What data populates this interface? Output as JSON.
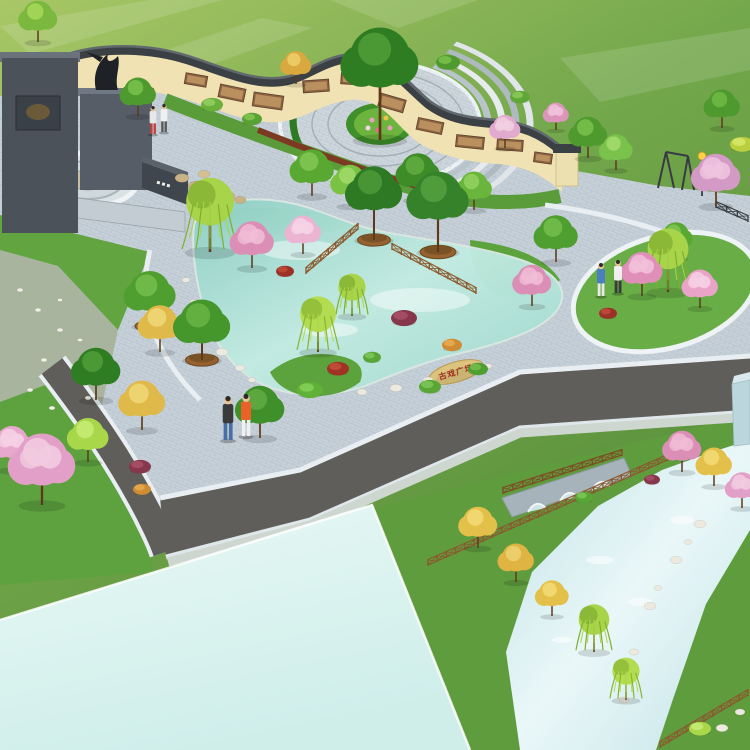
{
  "alt_text": "Aerial 3D landscape rendering of a public plaza park: S-curved cream mural wall with dark tile coping, dark stone entry monument with sculpture, circular ring-paved court with central tree, ornamental kidney-shaped pond with rock cascade, flowering and willow trees, curved roads, a canal with a stone arch bridge and wooden fences, and a large pale reflecting water surface",
  "palette": {
    "field_light": "#a9c766",
    "field_mid": "#74a84c",
    "field_dark": "#558c38",
    "paving": "#c6d0d8",
    "paving_edge": "#e8eef2",
    "road": "#5f5e5a",
    "sidewalk": "#cdd7d0",
    "wall_cream": "#f0e2b2",
    "wall_coping": "#3b4044",
    "mural_brown": "#8a6242",
    "wall_base_red": "#7c3a22",
    "pond_light": "#d9f2ec",
    "pond_deep": "#8ecfc4",
    "big_water": "#ddf3f0",
    "canal_water": "#cfe9ec",
    "monument_dark": "#4c525a",
    "monument_mid": "#575d66",
    "wood_fence": "#8a5a2e",
    "stone_tan": "#dcc47e",
    "grass_bed": "#5da33d"
  },
  "scene": {
    "stone_inscription": {
      "text": "古戏广场",
      "color": "#a32c1e"
    },
    "murals": [
      {
        "x": 196,
        "y": 80,
        "w": 22,
        "h": 11,
        "r": 10
      },
      {
        "x": 232,
        "y": 93,
        "w": 26,
        "h": 13,
        "r": 12
      },
      {
        "x": 268,
        "y": 101,
        "w": 30,
        "h": 14,
        "r": 8
      },
      {
        "x": 316,
        "y": 86,
        "w": 26,
        "h": 12,
        "r": -4
      },
      {
        "x": 352,
        "y": 79,
        "w": 22,
        "h": 11,
        "r": 4
      },
      {
        "x": 392,
        "y": 103,
        "w": 26,
        "h": 13,
        "r": 16
      },
      {
        "x": 430,
        "y": 126,
        "w": 26,
        "h": 12,
        "r": 12
      },
      {
        "x": 470,
        "y": 142,
        "w": 28,
        "h": 12,
        "r": 6
      },
      {
        "x": 510,
        "y": 145,
        "w": 26,
        "h": 11,
        "r": 4
      },
      {
        "x": 543,
        "y": 158,
        "w": 18,
        "h": 10,
        "r": 8
      }
    ],
    "stones": [
      {
        "x": 208,
        "y": 332,
        "r": 5,
        "c": "#eceadf"
      },
      {
        "x": 222,
        "y": 352,
        "r": 6,
        "c": "#eceadf"
      },
      {
        "x": 240,
        "y": 368,
        "r": 5,
        "c": "#eceadf"
      },
      {
        "x": 194,
        "y": 302,
        "r": 4,
        "c": "#eceadf"
      },
      {
        "x": 186,
        "y": 280,
        "r": 4,
        "c": "#eceadf"
      },
      {
        "x": 252,
        "y": 380,
        "r": 4,
        "c": "#eceadf"
      },
      {
        "x": 362,
        "y": 392,
        "r": 5,
        "c": "#eceadf"
      },
      {
        "x": 396,
        "y": 388,
        "r": 6,
        "c": "#eceadf"
      },
      {
        "x": 428,
        "y": 380,
        "r": 5,
        "c": "#eceadf"
      },
      {
        "x": 488,
        "y": 366,
        "r": 4,
        "c": "#eceadf"
      },
      {
        "x": 700,
        "y": 524,
        "r": 6,
        "c": "#eceadf"
      },
      {
        "x": 676,
        "y": 560,
        "r": 6,
        "c": "#eceadf"
      },
      {
        "x": 650,
        "y": 606,
        "r": 6,
        "c": "#eceadf"
      },
      {
        "x": 634,
        "y": 652,
        "r": 5,
        "c": "#eceadf"
      },
      {
        "x": 624,
        "y": 700,
        "r": 5,
        "c": "#eceadf"
      },
      {
        "x": 688,
        "y": 542,
        "r": 4,
        "c": "#eceadf"
      },
      {
        "x": 658,
        "y": 588,
        "r": 4,
        "c": "#eceadf"
      },
      {
        "x": 722,
        "y": 728,
        "r": 6,
        "c": "#eceadf"
      },
      {
        "x": 740,
        "y": 712,
        "r": 5,
        "c": "#eceadf"
      },
      {
        "x": 20,
        "y": 290,
        "r": 3,
        "c": "#f0efe6"
      },
      {
        "x": 38,
        "y": 310,
        "r": 3,
        "c": "#f0efe6"
      },
      {
        "x": 60,
        "y": 330,
        "r": 3,
        "c": "#f0efe6"
      },
      {
        "x": 44,
        "y": 360,
        "r": 3,
        "c": "#f0efe6"
      },
      {
        "x": 74,
        "y": 366,
        "r": 3,
        "c": "#f0efe6"
      },
      {
        "x": 30,
        "y": 390,
        "r": 3,
        "c": "#f0efe6"
      },
      {
        "x": 88,
        "y": 398,
        "r": 3,
        "c": "#f0efe6"
      },
      {
        "x": 60,
        "y": 300,
        "r": 2.5,
        "c": "#f0efe6"
      },
      {
        "x": 80,
        "y": 340,
        "r": 2.5,
        "c": "#f0efe6"
      },
      {
        "x": 52,
        "y": 408,
        "r": 3,
        "c": "#f0efe6"
      },
      {
        "x": 182,
        "y": 178,
        "r": 7,
        "c": "#c9b286"
      },
      {
        "x": 196,
        "y": 186,
        "r": 8,
        "c": "#c9b286"
      },
      {
        "x": 212,
        "y": 192,
        "r": 8,
        "c": "#bfa87c"
      },
      {
        "x": 228,
        "y": 196,
        "r": 7,
        "c": "#c9b286"
      },
      {
        "x": 204,
        "y": 174,
        "r": 6,
        "c": "#d4c092"
      },
      {
        "x": 240,
        "y": 200,
        "r": 6,
        "c": "#c9b286"
      }
    ],
    "vegetation": [
      {
        "k": "tree",
        "x": 38,
        "y": 42,
        "s": 15,
        "c": "#7ab93e",
        "c2": "#a8d858"
      },
      {
        "k": "tree",
        "x": 138,
        "y": 116,
        "s": 14,
        "c": "#4f9a2e",
        "c2": "#79c24b"
      },
      {
        "k": "tree",
        "x": 296,
        "y": 84,
        "s": 12,
        "c": "#d9a93f",
        "c2": "#edcf6a"
      },
      {
        "k": "tree",
        "x": 380,
        "y": 140,
        "s": 30,
        "t": 2.2,
        "c": "#2f7d22",
        "c2": "#4f9e38"
      },
      {
        "k": "shrub",
        "x": 212,
        "y": 108,
        "s": 11,
        "c": "#6ab13c",
        "c2": "#93cf5e"
      },
      {
        "k": "shrub",
        "x": 252,
        "y": 122,
        "s": 10,
        "c": "#58a233",
        "c2": "#85c553"
      },
      {
        "k": "shrub",
        "x": 448,
        "y": 66,
        "s": 12,
        "c": "#4f9a2e",
        "c2": "#79c24b"
      },
      {
        "k": "shrub",
        "x": 520,
        "y": 100,
        "s": 10,
        "c": "#5fa838",
        "c2": "#8cc95a"
      },
      {
        "k": "blossom",
        "x": 556,
        "y": 130,
        "s": 10,
        "c": "#dc96bc",
        "c2": "#f0c2da"
      },
      {
        "k": "tree",
        "x": 588,
        "y": 158,
        "s": 15,
        "c": "#4f9a2e",
        "c2": "#79c24b"
      },
      {
        "k": "tree",
        "x": 616,
        "y": 170,
        "s": 13,
        "c": "#79c24b",
        "c2": "#a4dc6e"
      },
      {
        "k": "shrub",
        "x": 742,
        "y": 148,
        "s": 12,
        "c": "#b9cf3e",
        "c2": "#d8e86a"
      },
      {
        "k": "tree",
        "x": 722,
        "y": 128,
        "s": 14,
        "c": "#4f9a2e",
        "c2": "#6fb944"
      },
      {
        "k": "blossom",
        "x": 716,
        "y": 206,
        "s": 19,
        "c": "#d49ac6",
        "c2": "#eec4de"
      },
      {
        "k": "blossom",
        "x": 505,
        "y": 148,
        "s": 12,
        "c": "#e2aace",
        "c2": "#f2cfe2"
      },
      {
        "k": "tree",
        "x": 312,
        "y": 196,
        "s": 17,
        "c": "#58a832",
        "c2": "#82c755"
      },
      {
        "k": "tree",
        "x": 350,
        "y": 206,
        "s": 15,
        "c": "#79c243",
        "c2": "#a2da68"
      },
      {
        "k": "tree",
        "x": 418,
        "y": 200,
        "s": 17,
        "c": "#3e8c28",
        "c2": "#63ad40"
      },
      {
        "k": "shrub",
        "x": 448,
        "y": 212,
        "s": 11,
        "c": "#8fd050",
        "c2": "#b4e478"
      },
      {
        "k": "willow",
        "x": 210,
        "y": 252,
        "s": 28,
        "c": "#a8d44a",
        "c2": "#7fae2f"
      },
      {
        "k": "blossom",
        "x": 252,
        "y": 268,
        "s": 17,
        "c": "#dc8fb6",
        "c2": "#f0bcd6"
      },
      {
        "k": "blossom",
        "x": 303,
        "y": 254,
        "s": 14,
        "c": "#eab4d2",
        "c2": "#f6d4e6"
      },
      {
        "k": "shrub",
        "x": 285,
        "y": 274,
        "s": 9,
        "c": "#9c3128",
        "c2": "#c04a38"
      },
      {
        "k": "ptree",
        "x": 374,
        "y": 240,
        "s": 22,
        "t": 1.8,
        "c": "#2e7a24",
        "c2": "#4e9a38"
      },
      {
        "k": "ptree",
        "x": 438,
        "y": 252,
        "s": 24,
        "t": 1.8,
        "c": "#35822a",
        "c2": "#55a03e"
      },
      {
        "k": "tree",
        "x": 474,
        "y": 210,
        "s": 14,
        "c": "#6ab53c",
        "c2": "#92d160"
      },
      {
        "k": "ptree",
        "x": 150,
        "y": 326,
        "s": 20,
        "c": "#4f9e30",
        "c2": "#74bd4e"
      },
      {
        "k": "ptree",
        "x": 202,
        "y": 360,
        "s": 22,
        "c": "#45962b",
        "c2": "#69b545"
      },
      {
        "k": "willow",
        "x": 318,
        "y": 352,
        "s": 21,
        "c": "#b4dc50",
        "c2": "#88b433"
      },
      {
        "k": "willow",
        "x": 352,
        "y": 316,
        "s": 16,
        "c": "#a8d44a",
        "c2": "#7fae2f"
      },
      {
        "k": "shrub",
        "x": 338,
        "y": 372,
        "s": 11,
        "c": "#a03326",
        "c2": "#c4503a"
      },
      {
        "k": "shrub",
        "x": 372,
        "y": 360,
        "s": 9,
        "c": "#57a636",
        "c2": "#7ec758"
      },
      {
        "k": "shrub",
        "x": 404,
        "y": 322,
        "s": 13,
        "c": "#86374b",
        "c2": "#a85068"
      },
      {
        "k": "shrub",
        "x": 452,
        "y": 348,
        "s": 10,
        "c": "#cf8c33",
        "c2": "#e8ab52"
      },
      {
        "k": "shrub",
        "x": 310,
        "y": 394,
        "s": 13,
        "c": "#5fb237",
        "c2": "#85cf58"
      },
      {
        "k": "shrub",
        "x": 478,
        "y": 372,
        "s": 10,
        "c": "#4f9e30",
        "c2": "#74bd4e"
      },
      {
        "k": "shrub",
        "x": 430,
        "y": 390,
        "s": 11,
        "c": "#57a636",
        "c2": "#7ec758"
      },
      {
        "k": "tree",
        "x": 556,
        "y": 262,
        "s": 17,
        "c": "#4f9e30",
        "c2": "#74bd4e"
      },
      {
        "k": "blossom",
        "x": 532,
        "y": 306,
        "s": 15,
        "c": "#dc8fb6",
        "c2": "#f0bcd6"
      },
      {
        "k": "willow",
        "x": 668,
        "y": 292,
        "s": 24,
        "c": "#a8d44a",
        "c2": "#7fae2f"
      },
      {
        "k": "blossom",
        "x": 642,
        "y": 296,
        "s": 16,
        "c": "#df8fb8",
        "c2": "#f2c0da"
      },
      {
        "k": "blossom",
        "x": 700,
        "y": 308,
        "s": 14,
        "c": "#e8a3c6",
        "c2": "#f6cfe4"
      },
      {
        "k": "tree",
        "x": 676,
        "y": 258,
        "s": 13,
        "c": "#58a832",
        "c2": "#82c755"
      },
      {
        "k": "shrub",
        "x": 608,
        "y": 316,
        "s": 9,
        "c": "#9c3128",
        "c2": "#c04a38"
      },
      {
        "k": "tree",
        "x": 96,
        "y": 400,
        "s": 19,
        "c": "#2f7d22",
        "c2": "#4f9e38"
      },
      {
        "k": "tree",
        "x": 142,
        "y": 430,
        "s": 18,
        "c": "#dfb94a",
        "c2": "#f0d878"
      },
      {
        "k": "tree",
        "x": 88,
        "y": 462,
        "s": 16,
        "c": "#a8d84a",
        "c2": "#c8ec74"
      },
      {
        "k": "blossom",
        "x": 42,
        "y": 505,
        "s": 26,
        "c": "#e2a0c8",
        "c2": "#f2cbe0"
      },
      {
        "k": "shrub",
        "x": 140,
        "y": 470,
        "s": 11,
        "c": "#86374b",
        "c2": "#a85068"
      },
      {
        "k": "shrub",
        "x": 142,
        "y": 492,
        "s": 9,
        "c": "#cf8c33",
        "c2": "#e8ab52"
      },
      {
        "k": "tree",
        "x": 260,
        "y": 438,
        "s": 19,
        "c": "#3f8f2a",
        "c2": "#61ad42"
      },
      {
        "k": "tree",
        "x": 160,
        "y": 352,
        "s": 17,
        "c": "#dfb94a",
        "c2": "#f0d878"
      },
      {
        "k": "blossom",
        "x": 12,
        "y": 470,
        "s": 16,
        "c": "#e8a8cc",
        "c2": "#f6d2e6"
      },
      {
        "k": "tree",
        "x": 478,
        "y": 548,
        "s": 15,
        "c": "#e3c04a",
        "c2": "#f2da76"
      },
      {
        "k": "tree",
        "x": 516,
        "y": 582,
        "s": 14,
        "c": "#dfb443",
        "c2": "#efd26e"
      },
      {
        "k": "tree",
        "x": 552,
        "y": 616,
        "s": 13,
        "c": "#e3c04a",
        "c2": "#f2da76"
      },
      {
        "k": "willow",
        "x": 594,
        "y": 652,
        "s": 18,
        "c": "#a8d44a",
        "c2": "#7fae2f"
      },
      {
        "k": "willow",
        "x": 626,
        "y": 700,
        "s": 16,
        "c": "#b4dc50",
        "c2": "#88b433"
      },
      {
        "k": "blossom",
        "x": 682,
        "y": 472,
        "s": 15,
        "c": "#dc8fb6",
        "c2": "#f0bcd6"
      },
      {
        "k": "tree",
        "x": 714,
        "y": 486,
        "s": 14,
        "c": "#e3c04a",
        "c2": "#f2da76"
      },
      {
        "k": "blossom",
        "x": 742,
        "y": 508,
        "s": 13,
        "c": "#e2a0c8",
        "c2": "#f2cbe0"
      },
      {
        "k": "shrub",
        "x": 652,
        "y": 482,
        "s": 8,
        "c": "#86374b",
        "c2": "#a85068"
      },
      {
        "k": "shrub",
        "x": 700,
        "y": 732,
        "s": 11,
        "c": "#a8d84a",
        "c2": "#c8ec74"
      },
      {
        "k": "shrub",
        "x": 584,
        "y": 500,
        "s": 9,
        "c": "#57a636",
        "c2": "#7ec758"
      }
    ],
    "people": [
      {
        "x": 228,
        "y": 440,
        "h": 44,
        "shirt": "#3a3a3a",
        "legs": "#4a6fa5"
      },
      {
        "x": 246,
        "y": 436,
        "h": 42,
        "shirt": "#e8622a",
        "legs": "#f0f0f0"
      },
      {
        "x": 601,
        "y": 296,
        "h": 33,
        "shirt": "#4a7fc0",
        "legs": "#e8e8e8"
      },
      {
        "x": 618,
        "y": 293,
        "h": 33,
        "shirt": "#f0f0f0",
        "legs": "#3a3a3a"
      },
      {
        "x": 153,
        "y": 134,
        "h": 28,
        "shirt": "#e8e8e8",
        "legs": "#c04040"
      },
      {
        "x": 164,
        "y": 132,
        "h": 28,
        "shirt": "#f0f0f0",
        "legs": "#5a5a5a"
      }
    ],
    "fences": [
      {
        "x1": 358,
        "y1": 230,
        "x2": 306,
        "y2": 274,
        "c": "#8a5a2e"
      },
      {
        "x1": 392,
        "y1": 250,
        "x2": 476,
        "y2": 294,
        "c": "#8a5a2e"
      },
      {
        "x1": 428,
        "y1": 566,
        "x2": 695,
        "y2": 449,
        "c": "#8a5a2e"
      },
      {
        "x1": 503,
        "y1": 494,
        "x2": 622,
        "y2": 456,
        "c": "#7c4e24"
      },
      {
        "x1": 660,
        "y1": 748,
        "x2": 748,
        "y2": 696,
        "c": "#8a5a2e"
      },
      {
        "x1": 716,
        "y1": 208,
        "x2": 748,
        "y2": 222,
        "c": "#3c4248"
      }
    ]
  }
}
